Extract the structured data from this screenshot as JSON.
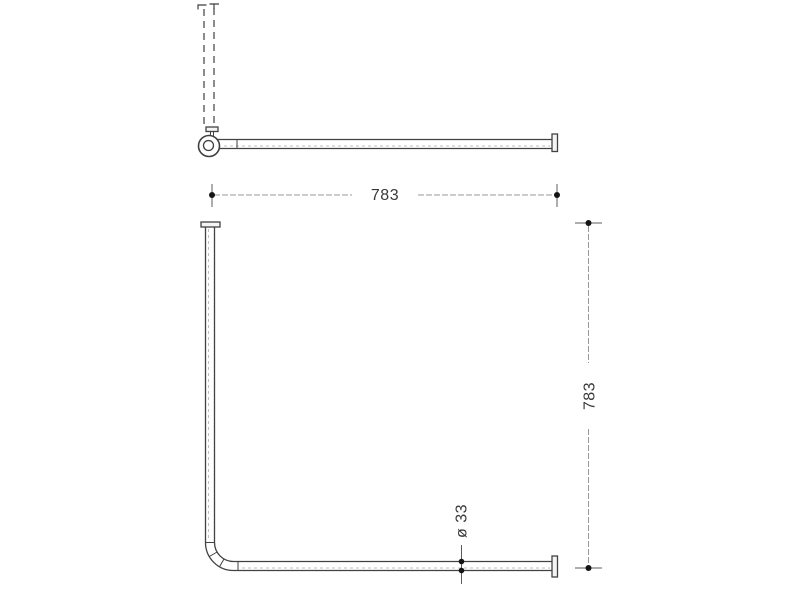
{
  "page": {
    "background": "#ffffff"
  },
  "drawing": {
    "name": "corner-shower-curtain-rail-technical-drawing",
    "labels": {
      "width": "783",
      "depth": "783",
      "diameter": "ø 33"
    },
    "colors": {
      "outline": "#424242",
      "dimension_line": "#979797",
      "dimension_tick": "#5c5c5c",
      "centerline": "#bfbfbf",
      "dot": "#141414",
      "text": "#3a3a3a",
      "background": "#ffffff"
    }
  }
}
